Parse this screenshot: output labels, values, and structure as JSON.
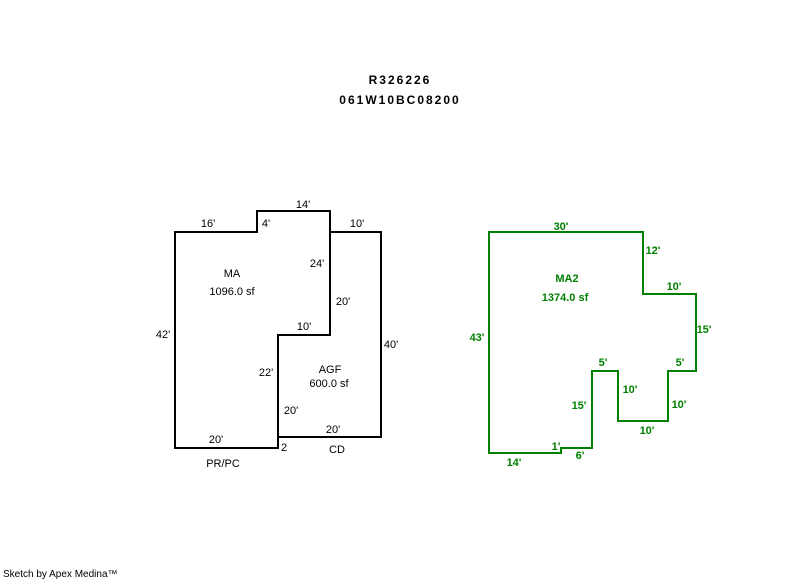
{
  "page": {
    "title_line1": "R326226",
    "title_line2": "061W10BC08200",
    "footer": "Sketch by Apex Medina™"
  },
  "colors": {
    "background": "#ffffff",
    "black_outline": "#000000",
    "green_outline": "#008000"
  },
  "sketch": {
    "shapes": [
      {
        "name": "ma-outline",
        "code": "MA",
        "area_sf": "1096.0 sf",
        "color": "#000000",
        "points": [
          [
            175,
            232
          ],
          [
            257,
            232
          ],
          [
            257,
            211
          ],
          [
            330,
            211
          ],
          [
            330,
            335
          ],
          [
            278,
            335
          ],
          [
            278,
            448
          ],
          [
            175,
            448
          ]
        ]
      },
      {
        "name": "agf-outline",
        "code": "AGF",
        "area_sf": "600.0 sf",
        "color": "#000000",
        "points": [
          [
            330,
            232
          ],
          [
            381,
            232
          ],
          [
            381,
            437
          ],
          [
            278,
            437
          ],
          [
            278,
            335
          ],
          [
            330,
            335
          ]
        ]
      },
      {
        "name": "ma2-outline",
        "code": "MA2",
        "area_sf": "1374.0 sf",
        "color": "#008000",
        "points": [
          [
            489,
            232
          ],
          [
            643,
            232
          ],
          [
            643,
            294
          ],
          [
            696,
            294
          ],
          [
            696,
            371
          ],
          [
            668,
            371
          ],
          [
            668,
            421
          ],
          [
            618,
            421
          ],
          [
            618,
            371
          ],
          [
            592,
            371
          ],
          [
            592,
            448
          ],
          [
            561,
            448
          ],
          [
            561,
            453
          ],
          [
            489,
            453
          ]
        ]
      }
    ],
    "labels": [
      {
        "name": "ma-dim-16",
        "text": "16'",
        "x": 208,
        "y": 227,
        "color": "#000000",
        "bold": false
      },
      {
        "name": "ma-dim-4",
        "text": "4'",
        "x": 266,
        "y": 227,
        "color": "#000000",
        "bold": false
      },
      {
        "name": "ma-dim-14",
        "text": "14'",
        "x": 303,
        "y": 208,
        "color": "#000000",
        "bold": false
      },
      {
        "name": "agf-dim-10-top",
        "text": "10'",
        "x": 357,
        "y": 227,
        "color": "#000000",
        "bold": false
      },
      {
        "name": "ma-dim-24",
        "text": "24'",
        "x": 317,
        "y": 267,
        "color": "#000000",
        "bold": false
      },
      {
        "name": "agf-dim-20-upper-left",
        "text": "20'",
        "x": 343,
        "y": 305,
        "color": "#000000",
        "bold": false
      },
      {
        "name": "agf-dim-10-inner",
        "text": "10'",
        "x": 304,
        "y": 330,
        "color": "#000000",
        "bold": false
      },
      {
        "name": "ma-dim-42",
        "text": "42'",
        "x": 163,
        "y": 338,
        "color": "#000000",
        "bold": false
      },
      {
        "name": "agf-dim-40",
        "text": "40'",
        "x": 391,
        "y": 348,
        "color": "#000000",
        "bold": false
      },
      {
        "name": "ma-dim-22",
        "text": "22'",
        "x": 266,
        "y": 376,
        "color": "#000000",
        "bold": false
      },
      {
        "name": "agf-dim-20-lower-left",
        "text": "20'",
        "x": 291,
        "y": 414,
        "color": "#000000",
        "bold": false
      },
      {
        "name": "agf-dim-20-bottom",
        "text": "20'",
        "x": 333,
        "y": 433,
        "color": "#000000",
        "bold": false
      },
      {
        "name": "ma-dim-20-bottom",
        "text": "20'",
        "x": 216,
        "y": 443,
        "color": "#000000",
        "bold": false
      },
      {
        "name": "ma-dim-2",
        "text": "2",
        "x": 284,
        "y": 451,
        "color": "#000000",
        "bold": false
      },
      {
        "name": "ma-shape-label",
        "text": "MA",
        "x": 232,
        "y": 277,
        "color": "#000000",
        "bold": false
      },
      {
        "name": "ma-area-label",
        "text": "1096.0 sf",
        "x": 232,
        "y": 295,
        "color": "#000000",
        "bold": false
      },
      {
        "name": "agf-shape-label",
        "text": "AGF",
        "x": 330,
        "y": 373,
        "color": "#000000",
        "bold": false
      },
      {
        "name": "agf-area-label",
        "text": "600.0 sf",
        "x": 329,
        "y": 387,
        "color": "#000000",
        "bold": false
      },
      {
        "name": "prpc-code-label",
        "text": "PR/PC",
        "x": 223,
        "y": 467,
        "color": "#000000",
        "bold": false
      },
      {
        "name": "cd-code-label",
        "text": "CD",
        "x": 337,
        "y": 453,
        "color": "#000000",
        "bold": false
      },
      {
        "name": "ma2-dim-30",
        "text": "30'",
        "x": 561,
        "y": 230,
        "color": "#008000",
        "bold": true
      },
      {
        "name": "ma2-dim-12",
        "text": "12'",
        "x": 653,
        "y": 254,
        "color": "#008000",
        "bold": true
      },
      {
        "name": "ma2-dim-10-upper",
        "text": "10'",
        "x": 674,
        "y": 290,
        "color": "#008000",
        "bold": true
      },
      {
        "name": "ma2-dim-15-right",
        "text": "15'",
        "x": 704,
        "y": 333,
        "color": "#008000",
        "bold": true
      },
      {
        "name": "ma2-dim-43",
        "text": "43'",
        "x": 477,
        "y": 341,
        "color": "#008000",
        "bold": true
      },
      {
        "name": "ma2-dim-5-left",
        "text": "5'",
        "x": 603,
        "y": 366,
        "color": "#008000",
        "bold": true
      },
      {
        "name": "ma2-dim-5-right",
        "text": "5'",
        "x": 680,
        "y": 366,
        "color": "#008000",
        "bold": true
      },
      {
        "name": "ma2-dim-10-left-inner",
        "text": "10'",
        "x": 630,
        "y": 393,
        "color": "#008000",
        "bold": true
      },
      {
        "name": "ma2-dim-10-right-inner",
        "text": "10'",
        "x": 679,
        "y": 408,
        "color": "#008000",
        "bold": true
      },
      {
        "name": "ma2-dim-15-left",
        "text": "15'",
        "x": 579,
        "y": 409,
        "color": "#008000",
        "bold": true
      },
      {
        "name": "ma2-dim-10-bottom-inner",
        "text": "10'",
        "x": 647,
        "y": 434,
        "color": "#008000",
        "bold": true
      },
      {
        "name": "ma2-dim-1",
        "text": "1'",
        "x": 556,
        "y": 450,
        "color": "#008000",
        "bold": true
      },
      {
        "name": "ma2-dim-6",
        "text": "6'",
        "x": 580,
        "y": 459,
        "color": "#008000",
        "bold": true
      },
      {
        "name": "ma2-dim-14",
        "text": "14'",
        "x": 514,
        "y": 466,
        "color": "#008000",
        "bold": true
      },
      {
        "name": "ma2-shape-label",
        "text": "MA2",
        "x": 567,
        "y": 282,
        "color": "#008000",
        "bold": true
      },
      {
        "name": "ma2-area-label",
        "text": "1374.0 sf",
        "x": 565,
        "y": 301,
        "color": "#008000",
        "bold": true
      }
    ]
  }
}
